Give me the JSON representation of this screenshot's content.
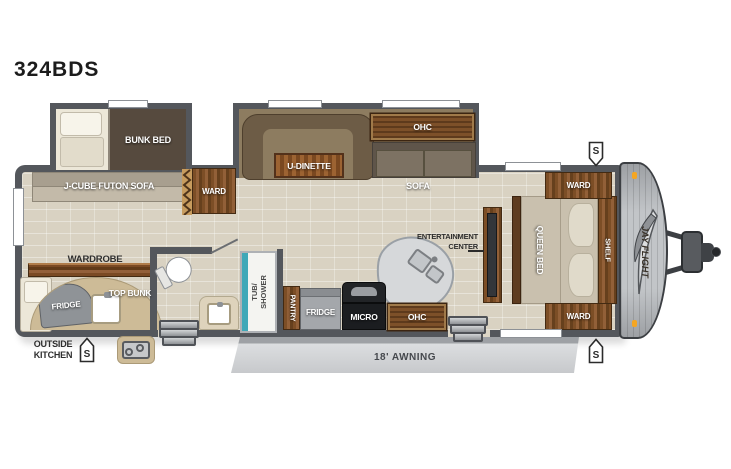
{
  "title": "324BDS",
  "colors": {
    "wall": "#54575c",
    "floor": "#d9d2c2",
    "wood": "#7c4e26",
    "shower_accent": "#3fa8b8",
    "awning": "#d9dbdd",
    "marker_light": "#f5a623"
  },
  "labels": {
    "bunk_bed": "BUNK BED",
    "j_cube_futon_sofa": "J-CUBE FUTON SOFA",
    "ward_mid": "WARD",
    "u_dinette": "U-DINETTE",
    "ohc_dinette": "OHC",
    "sofa": "SOFA",
    "wardrobe": "WARDROBE",
    "top_bunk": "TOP BUNK",
    "fridge_outside": "FRIDGE",
    "outside_kitchen": "OUTSIDE\nKITCHEN",
    "tub_shower": "TUB/\nSHOWER",
    "pantry": "PANTRY",
    "fridge_kitchen": "FRIDGE",
    "micro": "MICRO",
    "ohc_kitchen": "OHC",
    "entertainment_center": "ENTERTAINMENT\nCENTER",
    "queen_bed": "QUEEN BED",
    "shelf": "SHELF",
    "ward_front_top": "WARD",
    "ward_front_bottom": "WARD",
    "awning": "18' AWNING",
    "brand": "JAY FLIGHT",
    "speaker": "S"
  }
}
